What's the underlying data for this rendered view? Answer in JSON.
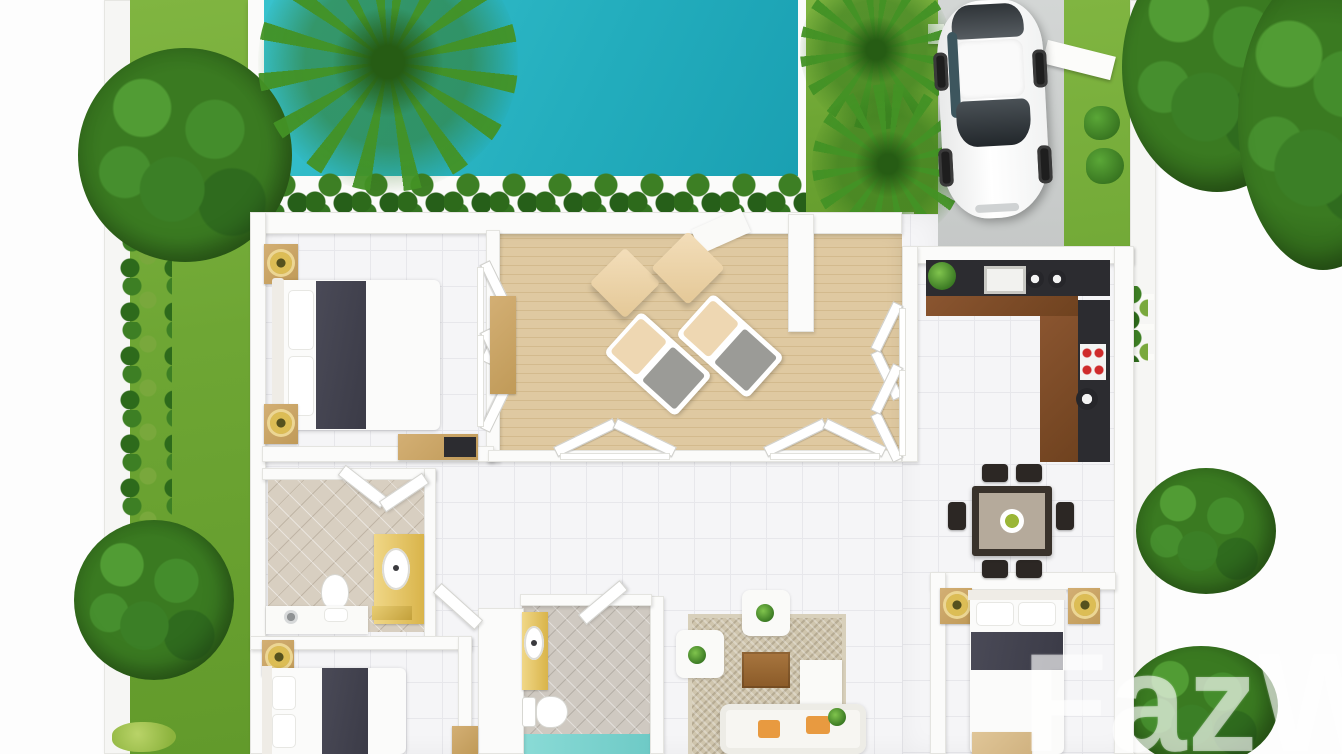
{
  "watermark": {
    "text": "FazW"
  },
  "scene": {
    "type": "3d-top-down-floor-plan",
    "description": "Top-down 3D architectural render of a single-storey pool villa with garden, wooden sun deck, driveway with parked car and surrounding trees",
    "rooms": [
      "bedroom-1",
      "bedroom-2",
      "bedroom-3",
      "bathroom-1",
      "bathroom-2",
      "kitchen",
      "dining-area",
      "living-room",
      "hallway",
      "terrace-deck"
    ],
    "outdoor_features": [
      "swimming-pool",
      "left-garden-lawn",
      "right-garden-lawn",
      "hedge-row",
      "round-trees",
      "palm-trees",
      "driveway",
      "white-sedan-car",
      "entry-steps",
      "gate-beam"
    ],
    "furniture": {
      "bedroom_1": [
        "double-bed-dark-runner",
        "nightstand-with-lamp-x2",
        "wardrobe",
        "console-desk"
      ],
      "bedroom_2": [
        "double-bed-dark-runner",
        "nightstand-with-lamp"
      ],
      "bedroom_3": [
        "double-bed-dark-runner",
        "nightstand-with-lamp-x2",
        "foot-bench"
      ],
      "bathroom_1": [
        "toilet",
        "yellow-vanity-with-sink",
        "counter-with-faucet",
        "towels"
      ],
      "bathroom_2": [
        "toilet",
        "yellow-vanity-with-sink",
        "teal-shower-floor"
      ],
      "kitchen": [
        "l-shaped-counter",
        "sink",
        "cooktop-red-burners",
        "round-basin",
        "counter-plant"
      ],
      "dining_area": [
        "six-seat-dining-table",
        "fruit-bowl"
      ],
      "living_room": [
        "sofa-orange-cushions",
        "armchair-x2",
        "coffee-tv-cabinet",
        "area-rug",
        "side-unit",
        "plants"
      ],
      "terrace_deck": [
        "sun-lounger-x2",
        "pouf-x2",
        "door-mat"
      ]
    },
    "palette": {
      "pool_water": "#23adbd",
      "lawn_green": "#6ea634",
      "tree_green": "#3a7a21",
      "hedge_green": "#2d6a1b",
      "deck_wood": "#d9c297",
      "driveway_gray": "#cbcecd",
      "floor_tile": "#f5f5f7",
      "wall_white": "#fbfbfa",
      "bed_runner": "#40404c",
      "furniture_wood": "#c9a76b",
      "kitchen_wood": "#7c4b28",
      "counter_dark": "#2c2c30",
      "vanity_yellow": "#e5c45e",
      "bath_tile": "#d8cfc1",
      "shower_teal": "#7fd7d2",
      "rug_beige": "#cfc5ad",
      "cushion_orange": "#e89a40",
      "lamp_gold": "#d8b958",
      "car_white": "#f2f3f3",
      "watermark_white": "rgba(255,255,255,0.55)"
    }
  }
}
